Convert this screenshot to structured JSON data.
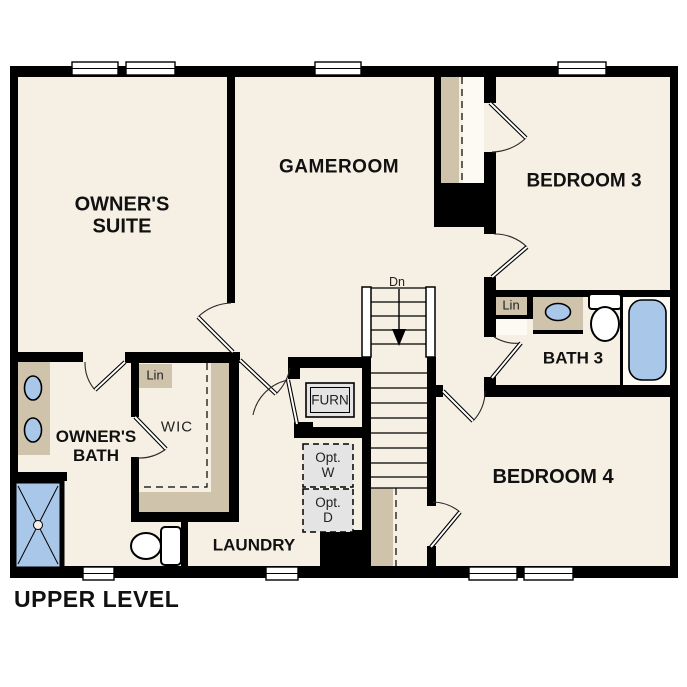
{
  "plan_title": "UPPER LEVEL",
  "colors": {
    "wall": "#000000",
    "floor": "#f6efe3",
    "tan": "#cfc3ab",
    "fixture_blue": "#a9c8e9",
    "optional_gray": "#e4e4e4",
    "background": "#ffffff",
    "text": "#111111"
  },
  "rooms": {
    "owners_suite": {
      "line1": "OWNER'S",
      "line2": "SUITE"
    },
    "gameroom": {
      "label": "GAMEROOM"
    },
    "bedroom3": {
      "label": "BEDROOM 3"
    },
    "bedroom4": {
      "label": "BEDROOM 4"
    },
    "bath3": {
      "label": "BATH 3"
    },
    "owners_bath": {
      "line1": "OWNER'S",
      "line2": "BATH"
    },
    "wic": {
      "label": "WIC"
    },
    "laundry": {
      "label": "LAUNDRY"
    }
  },
  "closets": {
    "linen_hall": {
      "label": "Lin"
    },
    "linen_bath3": {
      "label": "Lin"
    }
  },
  "stairs": {
    "down_label": "Dn"
  },
  "equipment": {
    "furnace": {
      "label": "FURN"
    },
    "optional_washer": {
      "line1": "Opt.",
      "line2": "W"
    },
    "optional_dryer": {
      "line1": "Opt.",
      "line2": "D"
    }
  }
}
